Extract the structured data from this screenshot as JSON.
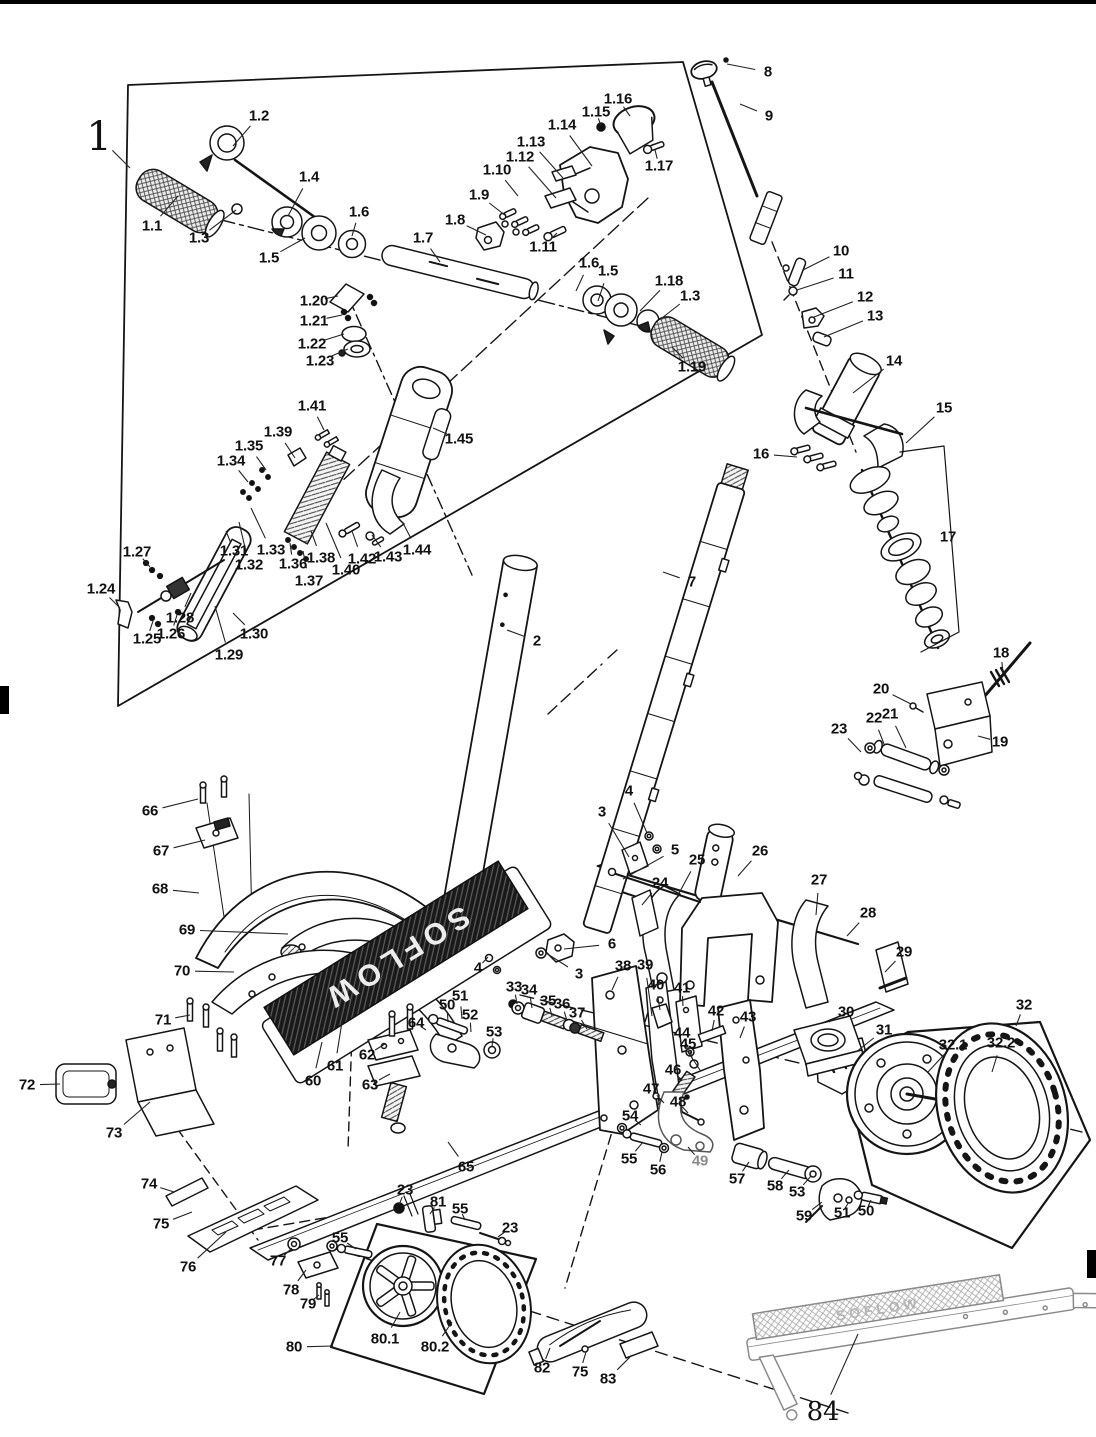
{
  "deck": {
    "brand": "SOFLOW"
  },
  "labels": [
    {
      "t": "1",
      "x": 99,
      "y": 137,
      "fs": 40,
      "lx": 130,
      "ly": 168
    },
    {
      "t": "1.1",
      "x": 152,
      "y": 226,
      "lx": 178,
      "ly": 196
    },
    {
      "t": "1.2",
      "x": 259,
      "y": 116,
      "lx": 233,
      "ly": 146
    },
    {
      "t": "1.3",
      "x": 199,
      "y": 238,
      "lx": 236,
      "ly": 210
    },
    {
      "t": "1.4",
      "x": 309,
      "y": 177,
      "lx": 288,
      "ly": 216
    },
    {
      "t": "1.5",
      "x": 269,
      "y": 258,
      "lx": 305,
      "ly": 238
    },
    {
      "t": "1.6",
      "x": 359,
      "y": 212,
      "lx": 352,
      "ly": 236
    },
    {
      "t": "1.7",
      "x": 423,
      "y": 238,
      "lx": 440,
      "ly": 262
    },
    {
      "t": "1.8",
      "x": 455,
      "y": 220,
      "lx": 486,
      "ly": 235
    },
    {
      "t": "1.9",
      "x": 479,
      "y": 195,
      "lx": 506,
      "ly": 216
    },
    {
      "t": "1.10",
      "x": 497,
      "y": 170,
      "lx": 518,
      "ly": 196
    },
    {
      "t": "1.11",
      "x": 543,
      "y": 247,
      "lx": 557,
      "ly": 233
    },
    {
      "t": "1.12",
      "x": 520,
      "y": 157,
      "lx": 556,
      "ly": 198
    },
    {
      "t": "1.13",
      "x": 531,
      "y": 142,
      "lx": 563,
      "ly": 178
    },
    {
      "t": "1.14",
      "x": 562,
      "y": 125,
      "lx": 592,
      "ly": 166
    },
    {
      "t": "1.15",
      "x": 596,
      "y": 112,
      "lx": 601,
      "ly": 126
    },
    {
      "t": "1.16",
      "x": 618,
      "y": 99,
      "lx": 630,
      "ly": 116
    },
    {
      "t": "1.17",
      "x": 659,
      "y": 166,
      "lx": 655,
      "ly": 150
    },
    {
      "t": "1.6",
      "x": 589,
      "y": 263,
      "lx": 576,
      "ly": 291
    },
    {
      "t": "1.5",
      "x": 608,
      "y": 271,
      "lx": 598,
      "ly": 301
    },
    {
      "t": "1.18",
      "x": 669,
      "y": 281,
      "lx": 640,
      "ly": 311
    },
    {
      "t": "1.3",
      "x": 690,
      "y": 296,
      "lx": 662,
      "ly": 318
    },
    {
      "t": "1.19",
      "x": 692,
      "y": 367,
      "lx": 672,
      "ly": 347
    },
    {
      "t": "1.20",
      "x": 314,
      "y": 301,
      "lx": 338,
      "ly": 296
    },
    {
      "t": "1.21",
      "x": 314,
      "y": 321,
      "lx": 342,
      "ly": 315
    },
    {
      "t": "1.22",
      "x": 312,
      "y": 344,
      "lx": 344,
      "ly": 334
    },
    {
      "t": "1.23",
      "x": 320,
      "y": 361,
      "lx": 348,
      "ly": 349
    },
    {
      "t": "1.41",
      "x": 312,
      "y": 406,
      "lx": 324,
      "ly": 430
    },
    {
      "t": "1.39",
      "x": 278,
      "y": 432,
      "lx": 295,
      "ly": 458
    },
    {
      "t": "1.35",
      "x": 249,
      "y": 446,
      "lx": 266,
      "ly": 470
    },
    {
      "t": "1.34",
      "x": 231,
      "y": 461,
      "lx": 248,
      "ly": 482
    },
    {
      "t": "1.45",
      "x": 459,
      "y": 439,
      "lx": 433,
      "ly": 428
    },
    {
      "t": "1.27",
      "x": 137,
      "y": 552,
      "lx": 150,
      "ly": 567
    },
    {
      "t": "1.24",
      "x": 101,
      "y": 589,
      "lx": 120,
      "ly": 608
    },
    {
      "t": "1.31",
      "x": 234,
      "y": 551,
      "lx": 226,
      "ly": 531
    },
    {
      "t": "1.32",
      "x": 249,
      "y": 565,
      "lx": 239,
      "ly": 522
    },
    {
      "t": "1.33",
      "x": 271,
      "y": 550,
      "lx": 251,
      "ly": 508
    },
    {
      "t": "1.36",
      "x": 293,
      "y": 564,
      "lx": 290,
      "ly": 543
    },
    {
      "t": "1.37",
      "x": 309,
      "y": 581,
      "lx": 303,
      "ly": 551
    },
    {
      "t": "1.38",
      "x": 321,
      "y": 558,
      "lx": 311,
      "ly": 531
    },
    {
      "t": "1.40",
      "x": 346,
      "y": 570,
      "lx": 326,
      "ly": 523
    },
    {
      "t": "1.42",
      "x": 362,
      "y": 559,
      "lx": 352,
      "ly": 531
    },
    {
      "t": "1.43",
      "x": 388,
      "y": 557,
      "lx": 372,
      "ly": 535
    },
    {
      "t": "1.44",
      "x": 417,
      "y": 550,
      "lx": 403,
      "ly": 523
    },
    {
      "t": "1.25",
      "x": 147,
      "y": 639,
      "lx": 153,
      "ly": 621
    },
    {
      "t": "1.26",
      "x": 171,
      "y": 634,
      "lx": 177,
      "ly": 615
    },
    {
      "t": "1.28",
      "x": 180,
      "y": 618,
      "lx": 191,
      "ly": 593
    },
    {
      "t": "1.29",
      "x": 229,
      "y": 655,
      "lx": 215,
      "ly": 606
    },
    {
      "t": "1.30",
      "x": 254,
      "y": 634,
      "lx": 233,
      "ly": 613
    },
    {
      "t": "8",
      "x": 768,
      "y": 72,
      "lx": 727,
      "ly": 64
    },
    {
      "t": "9",
      "x": 769,
      "y": 116,
      "lx": 740,
      "ly": 104
    },
    {
      "t": "10",
      "x": 841,
      "y": 251,
      "lx": 803,
      "ly": 270
    },
    {
      "t": "11",
      "x": 846,
      "y": 274,
      "lx": 797,
      "ly": 290
    },
    {
      "t": "12",
      "x": 865,
      "y": 297,
      "lx": 814,
      "ly": 317
    },
    {
      "t": "13",
      "x": 875,
      "y": 316,
      "lx": 824,
      "ly": 337
    },
    {
      "t": "14",
      "x": 894,
      "y": 361,
      "lx": 853,
      "ly": 393
    },
    {
      "t": "15",
      "x": 944,
      "y": 408,
      "lx": 906,
      "ly": 443
    },
    {
      "t": "16",
      "x": 761,
      "y": 454,
      "lx": 797,
      "ly": 457
    },
    {
      "t": "17",
      "x": 948,
      "y": 537
    },
    {
      "t": "18",
      "x": 1001,
      "y": 653,
      "lx": 1003,
      "ly": 673
    },
    {
      "t": "19",
      "x": 1000,
      "y": 742,
      "lx": 978,
      "ly": 736
    },
    {
      "t": "20",
      "x": 881,
      "y": 689,
      "lx": 911,
      "ly": 704
    },
    {
      "t": "21",
      "x": 890,
      "y": 714,
      "lx": 906,
      "ly": 748
    },
    {
      "t": "22",
      "x": 874,
      "y": 718,
      "lx": 884,
      "ly": 744
    },
    {
      "t": "23",
      "x": 839,
      "y": 729,
      "lx": 861,
      "ly": 752
    },
    {
      "t": "2",
      "x": 537,
      "y": 641,
      "lx": 507,
      "ly": 630
    },
    {
      "t": "7",
      "x": 692,
      "y": 582,
      "lx": 663,
      "ly": 572
    },
    {
      "t": "66",
      "x": 150,
      "y": 811,
      "lx": 198,
      "ly": 799
    },
    {
      "t": "67",
      "x": 161,
      "y": 851,
      "lx": 205,
      "ly": 840
    },
    {
      "t": "68",
      "x": 160,
      "y": 889,
      "lx": 199,
      "ly": 893
    },
    {
      "t": "69",
      "x": 187,
      "y": 930,
      "lx": 288,
      "ly": 934
    },
    {
      "t": "70",
      "x": 182,
      "y": 971,
      "lx": 234,
      "ly": 972
    },
    {
      "t": "3",
      "x": 602,
      "y": 812,
      "lx": 629,
      "ly": 857
    },
    {
      "t": "4",
      "x": 629,
      "y": 791,
      "lx": 647,
      "ly": 833
    },
    {
      "t": "5",
      "x": 675,
      "y": 850,
      "lx": 623,
      "ly": 879
    },
    {
      "t": "24",
      "x": 660,
      "y": 883,
      "lx": 642,
      "ly": 905
    },
    {
      "t": "25",
      "x": 697,
      "y": 860,
      "lx": 678,
      "ly": 895
    },
    {
      "t": "26",
      "x": 760,
      "y": 851,
      "lx": 738,
      "ly": 876
    },
    {
      "t": "27",
      "x": 819,
      "y": 880,
      "lx": 816,
      "ly": 915
    },
    {
      "t": "28",
      "x": 868,
      "y": 913,
      "lx": 847,
      "ly": 936
    },
    {
      "t": "29",
      "x": 904,
      "y": 952,
      "lx": 885,
      "ly": 972
    },
    {
      "t": "6",
      "x": 612,
      "y": 944,
      "lx": 564,
      "ly": 949
    },
    {
      "t": "3",
      "x": 579,
      "y": 974,
      "lx": 546,
      "ly": 953
    },
    {
      "t": "4",
      "x": 478,
      "y": 968,
      "lx": 488,
      "ly": 957
    },
    {
      "t": "33",
      "x": 514,
      "y": 987,
      "lx": 517,
      "ly": 1004
    },
    {
      "t": "34",
      "x": 529,
      "y": 990,
      "lx": 532,
      "ly": 1008
    },
    {
      "t": "35",
      "x": 548,
      "y": 1001,
      "lx": 552,
      "ly": 1016
    },
    {
      "t": "36",
      "x": 562,
      "y": 1004,
      "lx": 567,
      "ly": 1021
    },
    {
      "t": "37",
      "x": 577,
      "y": 1013,
      "lx": 587,
      "ly": 1029
    },
    {
      "t": "38",
      "x": 623,
      "y": 966,
      "lx": 612,
      "ly": 990
    },
    {
      "t": "39",
      "x": 645,
      "y": 965,
      "lx": 652,
      "ly": 1016
    },
    {
      "t": "40",
      "x": 656,
      "y": 985,
      "lx": 660,
      "ly": 1010
    },
    {
      "t": "41",
      "x": 682,
      "y": 988,
      "lx": 683,
      "ly": 1006
    },
    {
      "t": "42",
      "x": 716,
      "y": 1011,
      "lx": 712,
      "ly": 1031
    },
    {
      "t": "43",
      "x": 748,
      "y": 1017,
      "lx": 740,
      "ly": 1038
    },
    {
      "t": "44",
      "x": 682,
      "y": 1033,
      "lx": 689,
      "ly": 1050
    },
    {
      "t": "45",
      "x": 688,
      "y": 1044,
      "lx": 693,
      "ly": 1061
    },
    {
      "t": "46",
      "x": 673,
      "y": 1070,
      "lx": 682,
      "ly": 1081
    },
    {
      "t": "47",
      "x": 651,
      "y": 1089,
      "lx": 664,
      "ly": 1103
    },
    {
      "t": "48",
      "x": 678,
      "y": 1102,
      "lx": 688,
      "ly": 1113
    },
    {
      "t": "54",
      "x": 630,
      "y": 1116,
      "lx": 641,
      "ly": 1125
    },
    {
      "t": "55",
      "x": 629,
      "y": 1159,
      "lx": 643,
      "ly": 1142
    },
    {
      "t": "56",
      "x": 658,
      "y": 1170,
      "lx": 662,
      "ly": 1152
    },
    {
      "t": "49",
      "x": 700,
      "y": 1161,
      "c": "#8b8b8b",
      "lx": 688,
      "ly": 1147
    },
    {
      "t": "57",
      "x": 737,
      "y": 1179,
      "lx": 749,
      "ly": 1162
    },
    {
      "t": "58",
      "x": 775,
      "y": 1186,
      "lx": 789,
      "ly": 1170
    },
    {
      "t": "53",
      "x": 797,
      "y": 1192,
      "lx": 811,
      "ly": 1176
    },
    {
      "t": "59",
      "x": 804,
      "y": 1216,
      "lx": 822,
      "ly": 1202
    },
    {
      "t": "51",
      "x": 842,
      "y": 1213,
      "lx": 849,
      "ly": 1202
    },
    {
      "t": "50",
      "x": 866,
      "y": 1211,
      "lx": 871,
      "ly": 1200
    },
    {
      "t": "30",
      "x": 846,
      "y": 1012,
      "lx": 829,
      "ly": 1022
    },
    {
      "t": "31",
      "x": 884,
      "y": 1030,
      "lx": 856,
      "ly": 1052
    },
    {
      "t": "32",
      "x": 1024,
      "y": 1005,
      "lx": 1016,
      "ly": 1026
    },
    {
      "t": "32.1",
      "x": 953,
      "y": 1045,
      "lx": 928,
      "ly": 1072
    },
    {
      "t": "32.2",
      "x": 1001,
      "y": 1043,
      "lx": 992,
      "ly": 1072
    },
    {
      "t": "71",
      "x": 163,
      "y": 1020,
      "lx": 190,
      "ly": 1015
    },
    {
      "t": "72",
      "x": 27,
      "y": 1085,
      "lx": 60,
      "ly": 1084
    },
    {
      "t": "73",
      "x": 114,
      "y": 1133,
      "lx": 150,
      "ly": 1102
    },
    {
      "t": "74",
      "x": 149,
      "y": 1184,
      "lx": 174,
      "ly": 1192
    },
    {
      "t": "75",
      "x": 161,
      "y": 1224,
      "lx": 192,
      "ly": 1212
    },
    {
      "t": "76",
      "x": 188,
      "y": 1267,
      "lx": 226,
      "ly": 1232
    },
    {
      "t": "77",
      "x": 278,
      "y": 1261,
      "lx": 292,
      "ly": 1248
    },
    {
      "t": "78",
      "x": 291,
      "y": 1290,
      "lx": 306,
      "ly": 1270
    },
    {
      "t": "79",
      "x": 308,
      "y": 1304,
      "lx": 319,
      "ly": 1295
    },
    {
      "t": "60",
      "x": 313,
      "y": 1081,
      "lx": 322,
      "ly": 1042
    },
    {
      "t": "61",
      "x": 335,
      "y": 1066,
      "lx": 342,
      "ly": 1022
    },
    {
      "t": "62",
      "x": 367,
      "y": 1055,
      "lx": 385,
      "ly": 1044
    },
    {
      "t": "63",
      "x": 370,
      "y": 1085,
      "lx": 390,
      "ly": 1074
    },
    {
      "t": "64",
      "x": 416,
      "y": 1023,
      "lx": 426,
      "ly": 1030
    },
    {
      "t": "65",
      "x": 466,
      "y": 1167,
      "lx": 448,
      "ly": 1142
    },
    {
      "t": "50",
      "x": 447,
      "y": 1005,
      "lx": 448,
      "ly": 1022
    },
    {
      "t": "51",
      "x": 460,
      "y": 996,
      "lx": 462,
      "ly": 1019
    },
    {
      "t": "52",
      "x": 470,
      "y": 1015,
      "lx": 471,
      "ly": 1032
    },
    {
      "t": "53",
      "x": 494,
      "y": 1032,
      "lx": 492,
      "ly": 1046
    },
    {
      "t": "23",
      "x": 405,
      "y": 1190,
      "lx": 399,
      "ly": 1205
    },
    {
      "t": "81",
      "x": 438,
      "y": 1202,
      "lx": 430,
      "ly": 1214
    },
    {
      "t": "55",
      "x": 460,
      "y": 1209,
      "lx": 465,
      "ly": 1220
    },
    {
      "t": "23",
      "x": 510,
      "y": 1228,
      "lx": 498,
      "ly": 1237
    },
    {
      "t": "55",
      "x": 340,
      "y": 1238,
      "lx": 356,
      "ly": 1249
    },
    {
      "t": "80",
      "x": 294,
      "y": 1347,
      "lx": 333,
      "ly": 1346
    },
    {
      "t": "80.1",
      "x": 385,
      "y": 1339,
      "lx": 400,
      "ly": 1312
    },
    {
      "t": "80.2",
      "x": 435,
      "y": 1347,
      "lx": 452,
      "ly": 1322
    },
    {
      "t": "82",
      "x": 542,
      "y": 1368,
      "lx": 550,
      "ly": 1348
    },
    {
      "t": "75",
      "x": 580,
      "y": 1372,
      "lx": 586,
      "ly": 1352
    },
    {
      "t": "83",
      "x": 608,
      "y": 1379,
      "lx": 630,
      "ly": 1357
    },
    {
      "t": "84",
      "x": 823,
      "y": 1412,
      "fs": 26,
      "lx": 858,
      "ly": 1334
    }
  ]
}
